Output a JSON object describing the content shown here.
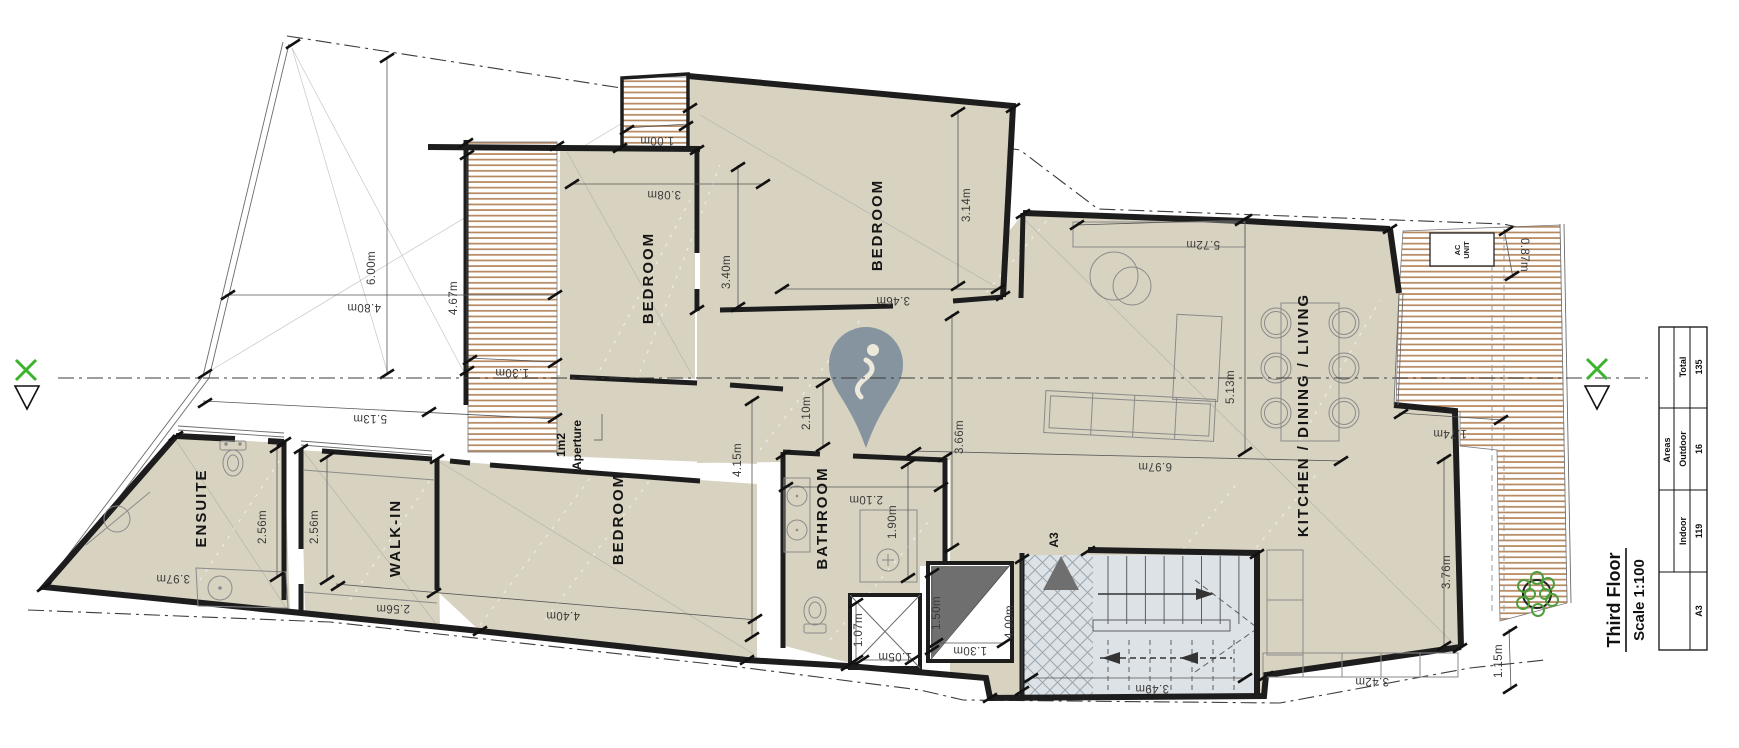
{
  "title_block": {
    "floor": "Third Floor",
    "scale": "Scale 1:100",
    "sheet": "A3"
  },
  "areas_table": {
    "title": "Areas",
    "rows": [
      {
        "label": "Indoor",
        "value": "119"
      },
      {
        "label": "Outdoor",
        "value": "16"
      },
      {
        "label": "Total",
        "value": "135"
      }
    ]
  },
  "rooms": {
    "ensuite": "ENSUITE",
    "walk_in": "WALK-IN",
    "bedroom_sw": "BEDROOM",
    "bedroom_n": "BEDROOM",
    "bedroom_ne": "BEDROOM",
    "bathroom": "BATHROOM",
    "kitchen": "KITCHEN / DINING / LIVING"
  },
  "annotations": {
    "aperture_line1": "1m2",
    "aperture_line2": "Aperture",
    "stair_core": "A3",
    "ac_line1": "AC",
    "ac_line2": "UNIT"
  },
  "dimensions": {
    "void_height": "6.00m",
    "void_width": "4.80m",
    "deck_left_height": "4.67m",
    "deck_left_width": "1.30m",
    "deck_top_width": "1.00m",
    "bedroom_n_width": "3.08m",
    "bedroom_n_depth": "3.40m",
    "bedroom_ne_width": "3.46m",
    "bedroom_ne_depth": "3.14m",
    "living_width": "5.72m",
    "living_depth": "5.13m",
    "kitchen_width": "6.97m",
    "deck_right_top": "0.87m",
    "deck_right_width": "1.74m",
    "front_width": "5.13m",
    "ensuite_width": "2.56m",
    "walkin_width": "2.56m",
    "walkin_depth": "2.56m",
    "ensuite_depth": "3.97m",
    "bedroom_sw_width": "4.40m",
    "bedroom_sw_depth": "4.15m",
    "hall_width": "2.10m",
    "bathroom_width": "2.10m",
    "shower_depth": "1.90m",
    "corridor_depth": "3.66m",
    "lift_width": "1.07m",
    "lift_depth": "1.05m",
    "shaft_depth": "1.50m",
    "shaft_width": "1.30m",
    "stair_depth": "4.00m",
    "stair_width": "3.49m",
    "kitchen_depth": "3.76m",
    "counter_width": "3.42m",
    "deck_right_bottom": "1.15m"
  },
  "colors": {
    "floor": "#d8d3c1",
    "deck_stripe": "#b5875f",
    "stairs_fill": "#dde2e6",
    "pin": "#7e8f9c",
    "accent_green": "#3bb42d",
    "dark_gray": "#6f6f6f",
    "wall": "#1d1d1d"
  }
}
